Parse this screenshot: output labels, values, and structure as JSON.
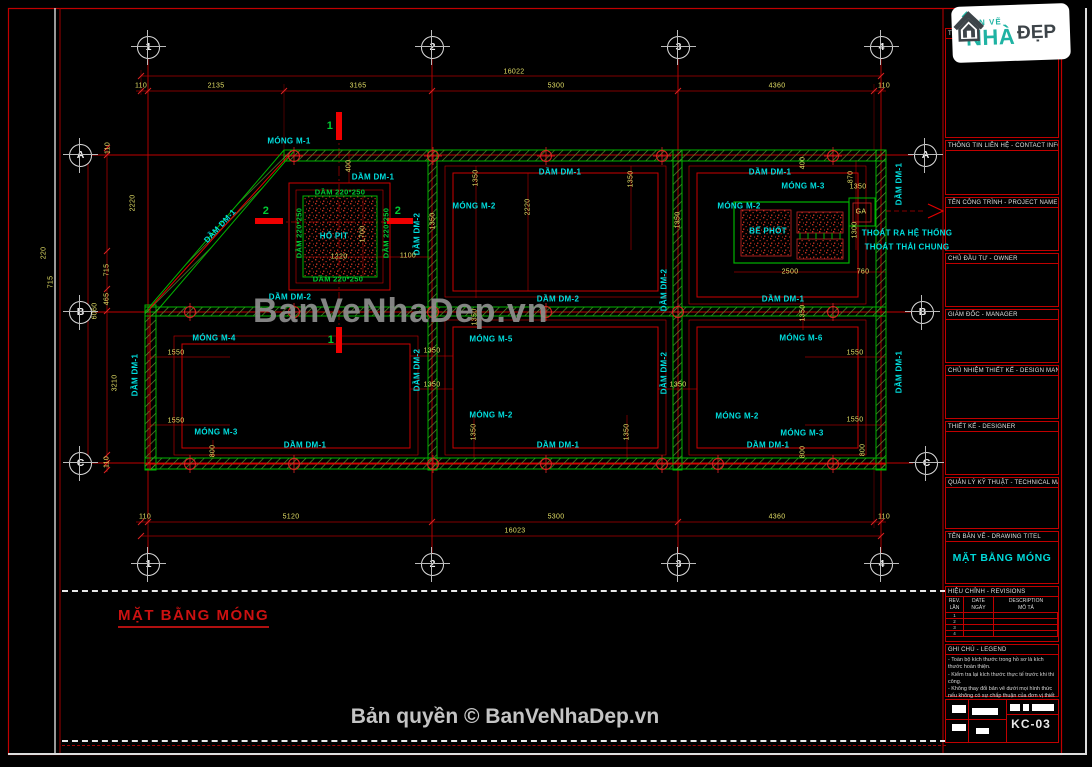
{
  "colors": {
    "line_red": "#cc0000",
    "wall_green": "#00b400",
    "label_cyan": "#00dede",
    "dim_yellow": "#e3df66",
    "logo_teal": "#1fb3a3"
  },
  "watermark": {
    "text": "BanVeNhaDep.vn"
  },
  "footer": {
    "copyright": "Bản quyền © BanVeNhaDep.vn"
  },
  "caption": {
    "title": "MẶT BẰNG MÓNG"
  },
  "logo": {
    "top": "BẢN VẼ",
    "main": "NHÀ",
    "right": "ĐẸP"
  },
  "titleblock": {
    "sections": [
      {
        "label": "TƯ VẤN -",
        "h": 110
      },
      {
        "label": "THÔNG TIN LIÊN HỆ - CONTACT INFO",
        "h": 55
      },
      {
        "label": "TÊN CÔNG TRÌNH - PROJECT NAME",
        "h": 54
      },
      {
        "label": "CHỦ ĐẦU TƯ - OWNER",
        "h": 54
      },
      {
        "label": "GIÁM ĐỐC - MANAGER",
        "h": 54
      },
      {
        "label": "CHỦ NHIỆM THIẾT KẾ - DESIGN MANAGER",
        "h": 54
      },
      {
        "label": "THIẾT KẾ - DESIGNER",
        "h": 54
      },
      {
        "label": "QUẢN LÝ KỸ THUẬT - TECHNICAL MANAGER",
        "h": 52
      }
    ],
    "drawing_title_label": "TÊN BẢN VẼ - DRAWING TITEL",
    "drawing_title": "MẶT BẰNG MÓNG",
    "revisions": {
      "label": "HIỆU CHỈNH - REVISIONS",
      "col_rev_en": "REV.",
      "col_rev_vn": "LẦN",
      "col_date_en": "DATE",
      "col_date_vn": "NGÀY",
      "col_desc_en": "DESCRIPTION",
      "col_desc_vn": "MÔ TẢ",
      "rows": [
        "1",
        "2",
        "3",
        "4"
      ]
    },
    "legend": {
      "label": "GHI CHÚ - LEGEND",
      "notes": [
        "- Toàn bộ kích thước trong hồ sơ là kích thước hoàn thiện.",
        "- Kiểm tra lại kích thước thực tế trước khi thi công.",
        "- Không thay đổi bản vẽ dưới mọi hình thức nếu không có sự chấp thuận của đơn vị thiết kế."
      ]
    },
    "sheet_no": "KC-03"
  },
  "plan": {
    "bubbles": [
      {
        "t": "1",
        "x": 148,
        "y": 47
      },
      {
        "t": "2",
        "x": 432,
        "y": 47
      },
      {
        "t": "3",
        "x": 678,
        "y": 47
      },
      {
        "t": "4",
        "x": 881,
        "y": 47
      },
      {
        "t": "1",
        "x": 148,
        "y": 564
      },
      {
        "t": "2",
        "x": 432,
        "y": 564
      },
      {
        "t": "3",
        "x": 678,
        "y": 564
      },
      {
        "t": "4",
        "x": 881,
        "y": 564
      },
      {
        "t": "A",
        "x": 80,
        "y": 155
      },
      {
        "t": "B",
        "x": 80,
        "y": 312
      },
      {
        "t": "C",
        "x": 80,
        "y": 463
      },
      {
        "t": "A",
        "x": 925,
        "y": 155
      },
      {
        "t": "B",
        "x": 922,
        "y": 312
      },
      {
        "t": "C",
        "x": 926,
        "y": 463
      }
    ],
    "labels": [
      {
        "t": "MÓNG M-1",
        "x": 289,
        "y": 141,
        "c": "cy"
      },
      {
        "t": "DẦM DM-1",
        "x": 373,
        "y": 177,
        "c": "cy"
      },
      {
        "t": "DẦM DM-1",
        "x": 560,
        "y": 172,
        "c": "cy"
      },
      {
        "t": "DẦM DM-1",
        "x": 770,
        "y": 172,
        "c": "cy"
      },
      {
        "t": "MÓNG M-3",
        "x": 803,
        "y": 186,
        "c": "cy"
      },
      {
        "t": "MÓNG M-2",
        "x": 474,
        "y": 206,
        "c": "cy"
      },
      {
        "t": "MÓNG M-2",
        "x": 739,
        "y": 206,
        "c": "cy"
      },
      {
        "t": "BỂ PHỐT",
        "x": 768,
        "y": 231,
        "c": "cy"
      },
      {
        "t": "THOÁT RA HỆ THỐNG",
        "x": 907,
        "y": 233,
        "c": "cy"
      },
      {
        "t": "THOÁT THẢI CHUNG",
        "x": 907,
        "y": 247,
        "c": "cy"
      },
      {
        "t": "DẦM DM-2",
        "x": 558,
        "y": 299,
        "c": "cy"
      },
      {
        "t": "DẦM DM-1",
        "x": 783,
        "y": 299,
        "c": "cy"
      },
      {
        "t": "DẦM DM-2",
        "x": 290,
        "y": 297,
        "c": "cy"
      },
      {
        "t": "MÓNG M-4",
        "x": 214,
        "y": 338,
        "c": "cy"
      },
      {
        "t": "MÓNG M-5",
        "x": 491,
        "y": 339,
        "c": "cy"
      },
      {
        "t": "MÓNG M-6",
        "x": 801,
        "y": 338,
        "c": "cy"
      },
      {
        "t": "MÓNG M-2",
        "x": 491,
        "y": 415,
        "c": "cy"
      },
      {
        "t": "MÓNG M-2",
        "x": 737,
        "y": 416,
        "c": "cy"
      },
      {
        "t": "MÓNG M-3",
        "x": 216,
        "y": 432,
        "c": "cy"
      },
      {
        "t": "MÓNG M-3",
        "x": 802,
        "y": 433,
        "c": "cy"
      },
      {
        "t": "DẦM DM-1",
        "x": 305,
        "y": 445,
        "c": "cy"
      },
      {
        "t": "DẦM DM-1",
        "x": 558,
        "y": 445,
        "c": "cy"
      },
      {
        "t": "DẦM DM-1",
        "x": 768,
        "y": 445,
        "c": "cy"
      },
      {
        "t": "HỐ PIT",
        "x": 334,
        "y": 236,
        "c": "cy"
      },
      {
        "t": "DẦM DM-1",
        "x": 135,
        "y": 375,
        "c": "cy",
        "r": -90
      },
      {
        "t": "DẦM DM-1",
        "x": 220,
        "y": 226,
        "c": "cy",
        "r": -47
      },
      {
        "t": "DẦM DM-2",
        "x": 417,
        "y": 234,
        "c": "cy",
        "r": -90
      },
      {
        "t": "DẦM DM-2",
        "x": 417,
        "y": 370,
        "c": "cy",
        "r": -90
      },
      {
        "t": "DẦM DM-2",
        "x": 664,
        "y": 290,
        "c": "cy",
        "r": -90
      },
      {
        "t": "DẦM DM-2",
        "x": 664,
        "y": 373,
        "c": "cy",
        "r": -90
      },
      {
        "t": "DẦM DM-1",
        "x": 899,
        "y": 184,
        "c": "cy",
        "r": -90
      },
      {
        "t": "DẦM DM-1",
        "x": 899,
        "y": 372,
        "c": "cy",
        "r": -90
      },
      {
        "t": "DẦM 220*250",
        "x": 340,
        "y": 192,
        "c": "gr"
      },
      {
        "t": "DẦM 220*250",
        "x": 338,
        "y": 279,
        "c": "gr"
      },
      {
        "t": "DẦM 220*250",
        "x": 299,
        "y": 233,
        "c": "gr",
        "r": -90
      },
      {
        "t": "DẦM 220*250",
        "x": 386,
        "y": 233,
        "c": "gr",
        "r": -90
      },
      {
        "t": "1",
        "x": 330,
        "y": 126,
        "c": "grb"
      },
      {
        "t": "1",
        "x": 331,
        "y": 340,
        "c": "grb"
      },
      {
        "t": "2",
        "x": 266,
        "y": 211,
        "c": "grb"
      },
      {
        "t": "2",
        "x": 398,
        "y": 211,
        "c": "grb"
      },
      {
        "t": "GA",
        "x": 861,
        "y": 212,
        "c": "yl"
      },
      {
        "t": "16022",
        "x": 514,
        "y": 72,
        "c": "yl"
      },
      {
        "t": "110",
        "x": 141,
        "y": 86,
        "c": "yl"
      },
      {
        "t": "2135",
        "x": 216,
        "y": 86,
        "c": "yl"
      },
      {
        "t": "3165",
        "x": 358,
        "y": 86,
        "c": "yl"
      },
      {
        "t": "5300",
        "x": 556,
        "y": 86,
        "c": "yl"
      },
      {
        "t": "4360",
        "x": 777,
        "y": 86,
        "c": "yl"
      },
      {
        "t": "110",
        "x": 884,
        "y": 86,
        "c": "yl"
      },
      {
        "t": "110",
        "x": 145,
        "y": 517,
        "c": "yl"
      },
      {
        "t": "5120",
        "x": 291,
        "y": 517,
        "c": "yl"
      },
      {
        "t": "5300",
        "x": 556,
        "y": 517,
        "c": "yl"
      },
      {
        "t": "4360",
        "x": 777,
        "y": 517,
        "c": "yl"
      },
      {
        "t": "110",
        "x": 884,
        "y": 517,
        "c": "yl"
      },
      {
        "t": "16023",
        "x": 515,
        "y": 531,
        "c": "yl"
      },
      {
        "t": "110",
        "x": 108,
        "y": 148,
        "c": "yl",
        "r": -90
      },
      {
        "t": "2220",
        "x": 133,
        "y": 203,
        "c": "yl",
        "r": -90
      },
      {
        "t": "715",
        "x": 107,
        "y": 270,
        "c": "yl",
        "r": -90
      },
      {
        "t": "465",
        "x": 107,
        "y": 299,
        "c": "yl",
        "r": -90
      },
      {
        "t": "6060",
        "x": 95,
        "y": 311,
        "c": "yl",
        "r": -90
      },
      {
        "t": "3210",
        "x": 115,
        "y": 383,
        "c": "yl",
        "r": -90
      },
      {
        "t": "110",
        "x": 107,
        "y": 462,
        "c": "yl",
        "r": -90
      },
      {
        "t": "220",
        "x": 44,
        "y": 253,
        "c": "yl",
        "r": -90
      },
      {
        "t": "715",
        "x": 51,
        "y": 282,
        "c": "yl",
        "r": -90
      },
      {
        "t": "400",
        "x": 349,
        "y": 166,
        "c": "yl",
        "r": -90
      },
      {
        "t": "1220",
        "x": 339,
        "y": 257,
        "c": "yl"
      },
      {
        "t": "1700",
        "x": 363,
        "y": 234,
        "c": "yl",
        "r": -90
      },
      {
        "t": "1100",
        "x": 408,
        "y": 256,
        "c": "yl"
      },
      {
        "t": "1350",
        "x": 433,
        "y": 221,
        "c": "yl",
        "r": -90
      },
      {
        "t": "1350",
        "x": 476,
        "y": 178,
        "c": "yl",
        "r": -90
      },
      {
        "t": "2220",
        "x": 528,
        "y": 207,
        "c": "yl",
        "r": -90
      },
      {
        "t": "1350",
        "x": 631,
        "y": 179,
        "c": "yl",
        "r": -90
      },
      {
        "t": "1350",
        "x": 678,
        "y": 220,
        "c": "yl",
        "r": -90
      },
      {
        "t": "400",
        "x": 803,
        "y": 163,
        "c": "yl",
        "r": -90
      },
      {
        "t": "870",
        "x": 851,
        "y": 177,
        "c": "yl",
        "r": -90
      },
      {
        "t": "1350",
        "x": 858,
        "y": 187,
        "c": "yl"
      },
      {
        "t": "1300",
        "x": 855,
        "y": 230,
        "c": "yl",
        "r": -90
      },
      {
        "t": "2500",
        "x": 790,
        "y": 272,
        "c": "yl"
      },
      {
        "t": "760",
        "x": 863,
        "y": 272,
        "c": "yl"
      },
      {
        "t": "1350",
        "x": 475,
        "y": 317,
        "c": "yl",
        "r": -90
      },
      {
        "t": "1350",
        "x": 432,
        "y": 351,
        "c": "yl"
      },
      {
        "t": "1350",
        "x": 432,
        "y": 385,
        "c": "yl"
      },
      {
        "t": "1350",
        "x": 678,
        "y": 385,
        "c": "yl"
      },
      {
        "t": "1350",
        "x": 803,
        "y": 313,
        "c": "yl",
        "r": -90
      },
      {
        "t": "1550",
        "x": 176,
        "y": 353,
        "c": "yl"
      },
      {
        "t": "1550",
        "x": 176,
        "y": 421,
        "c": "yl"
      },
      {
        "t": "1550",
        "x": 855,
        "y": 353,
        "c": "yl"
      },
      {
        "t": "1550",
        "x": 855,
        "y": 420,
        "c": "yl"
      },
      {
        "t": "1350",
        "x": 474,
        "y": 432,
        "c": "yl",
        "r": -90
      },
      {
        "t": "1350",
        "x": 627,
        "y": 432,
        "c": "yl",
        "r": -90
      },
      {
        "t": "800",
        "x": 863,
        "y": 450,
        "c": "yl",
        "r": -90
      },
      {
        "t": "800",
        "x": 803,
        "y": 452,
        "c": "yl",
        "r": -90
      },
      {
        "t": "800",
        "x": 213,
        "y": 451,
        "c": "yl",
        "r": -90
      }
    ]
  }
}
